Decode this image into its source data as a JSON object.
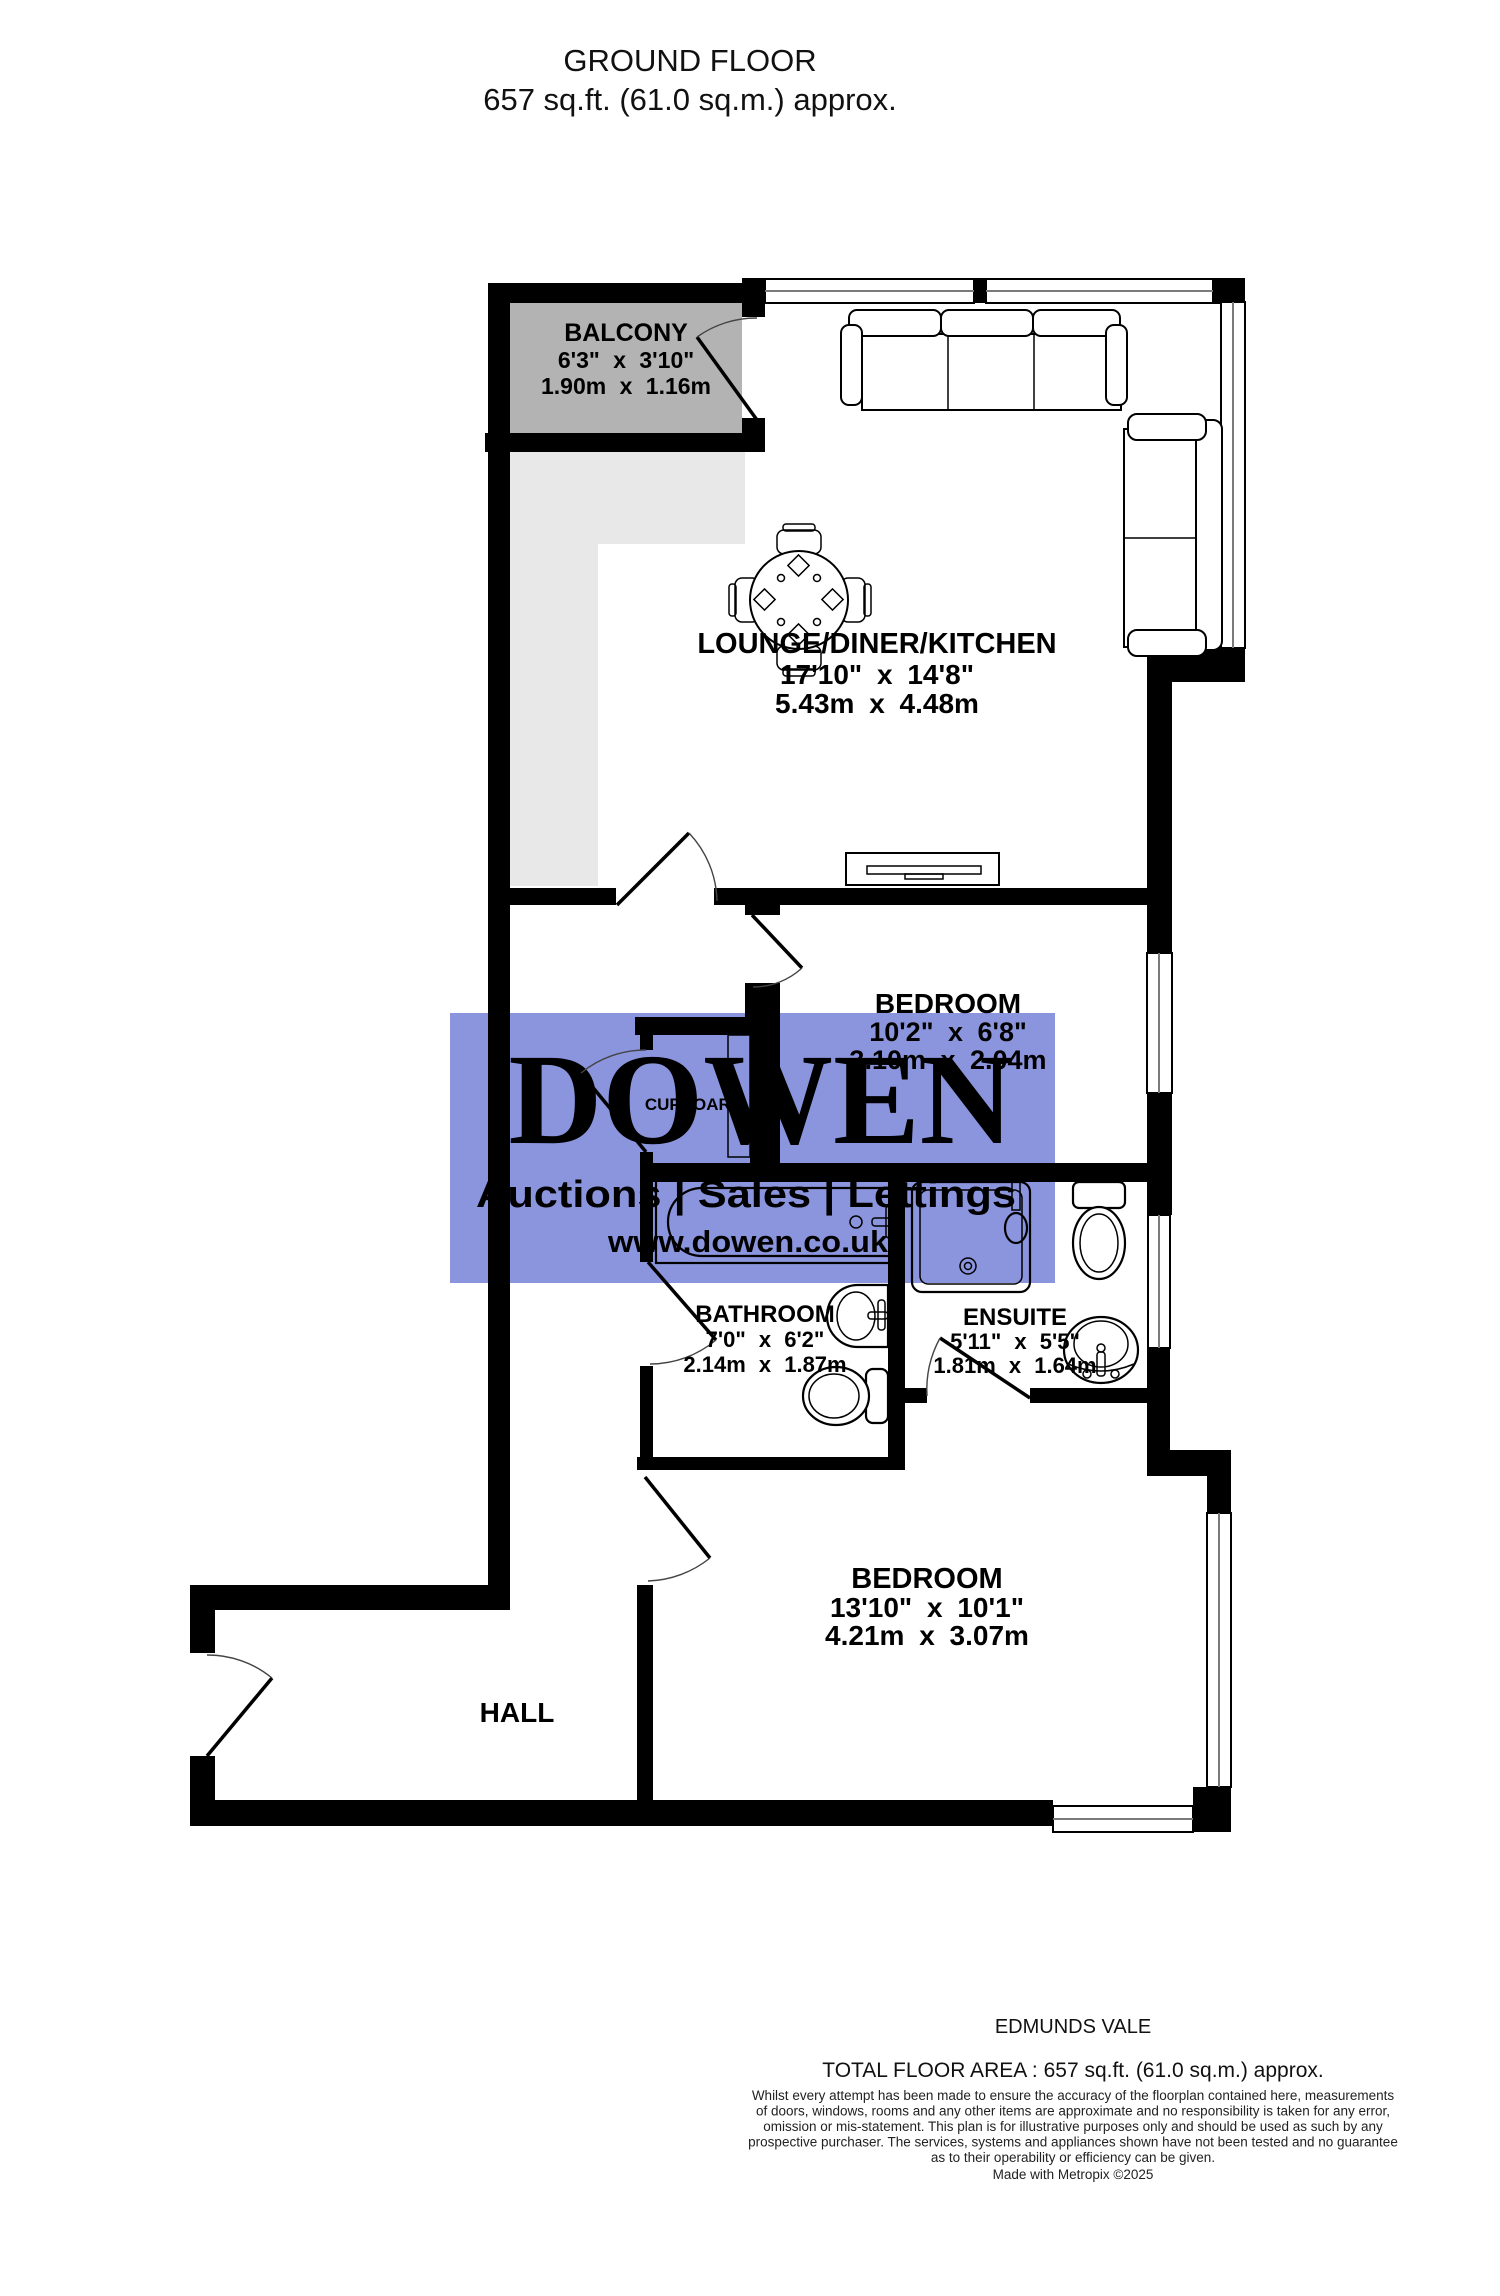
{
  "title": {
    "line1": "GROUND FLOOR",
    "line2": "657 sq.ft. (61.0 sq.m.) approx."
  },
  "rooms": [
    {
      "name": "BALCONY",
      "imperial": "6'3\" x 3'10\"",
      "metric": "1.90m x 1.16m"
    },
    {
      "name": "LOUNGE/DINER/KITCHEN",
      "imperial": "17'10\" x 14'8\"",
      "metric": "5.43m x 4.48m"
    },
    {
      "name": "BEDROOM",
      "imperial": "10'2\" x 6'8\"",
      "metric": "3.10m x 2.04m"
    },
    {
      "name": "CUPBOARD"
    },
    {
      "name": "BATHROOM",
      "imperial": "7'0\" x 6'2\"",
      "metric": "2.14m x 1.87m"
    },
    {
      "name": "ENSUITE",
      "imperial": "5'11\" x 5'5\"",
      "metric": "1.81m x 1.64m"
    },
    {
      "name": "BEDROOM",
      "imperial": "13'10\" x 10'1\"",
      "metric": "4.21m x 3.07m"
    },
    {
      "name": "HALL"
    }
  ],
  "watermark": {
    "brand": "DOWEN",
    "tagline": "Auctions  |  Sales  |  Lettings",
    "website": "www.dowen.co.uk",
    "bg_color": "#8b95dd",
    "brand_color": "#f0ee8e",
    "tagline_color": "#ffffff",
    "website_color": "#f0ee8e"
  },
  "footer": {
    "property_name": "EDMUNDS VALE",
    "total_area": "TOTAL FLOOR AREA : 657 sq.ft. (61.0 sq.m.) approx.",
    "disclaimer_lines": [
      "Whilst every attempt has been made to ensure the accuracy of the floorplan contained here, measurements",
      "of doors, windows, rooms and any other items are approximate and no responsibility is taken for any error,",
      "omission or mis-statement. This plan is for illustrative purposes only and should be used as such by any",
      "prospective purchaser. The services, systems and appliances shown have not been tested and no guarantee",
      "as to their operability or efficiency can be given."
    ],
    "credit": "Made with Metropix ©2025"
  },
  "colors": {
    "wall": "#000000",
    "balcony_fill": "#b3b3b3",
    "shaded_fill": "#e8e8e8",
    "background": "#ffffff"
  }
}
